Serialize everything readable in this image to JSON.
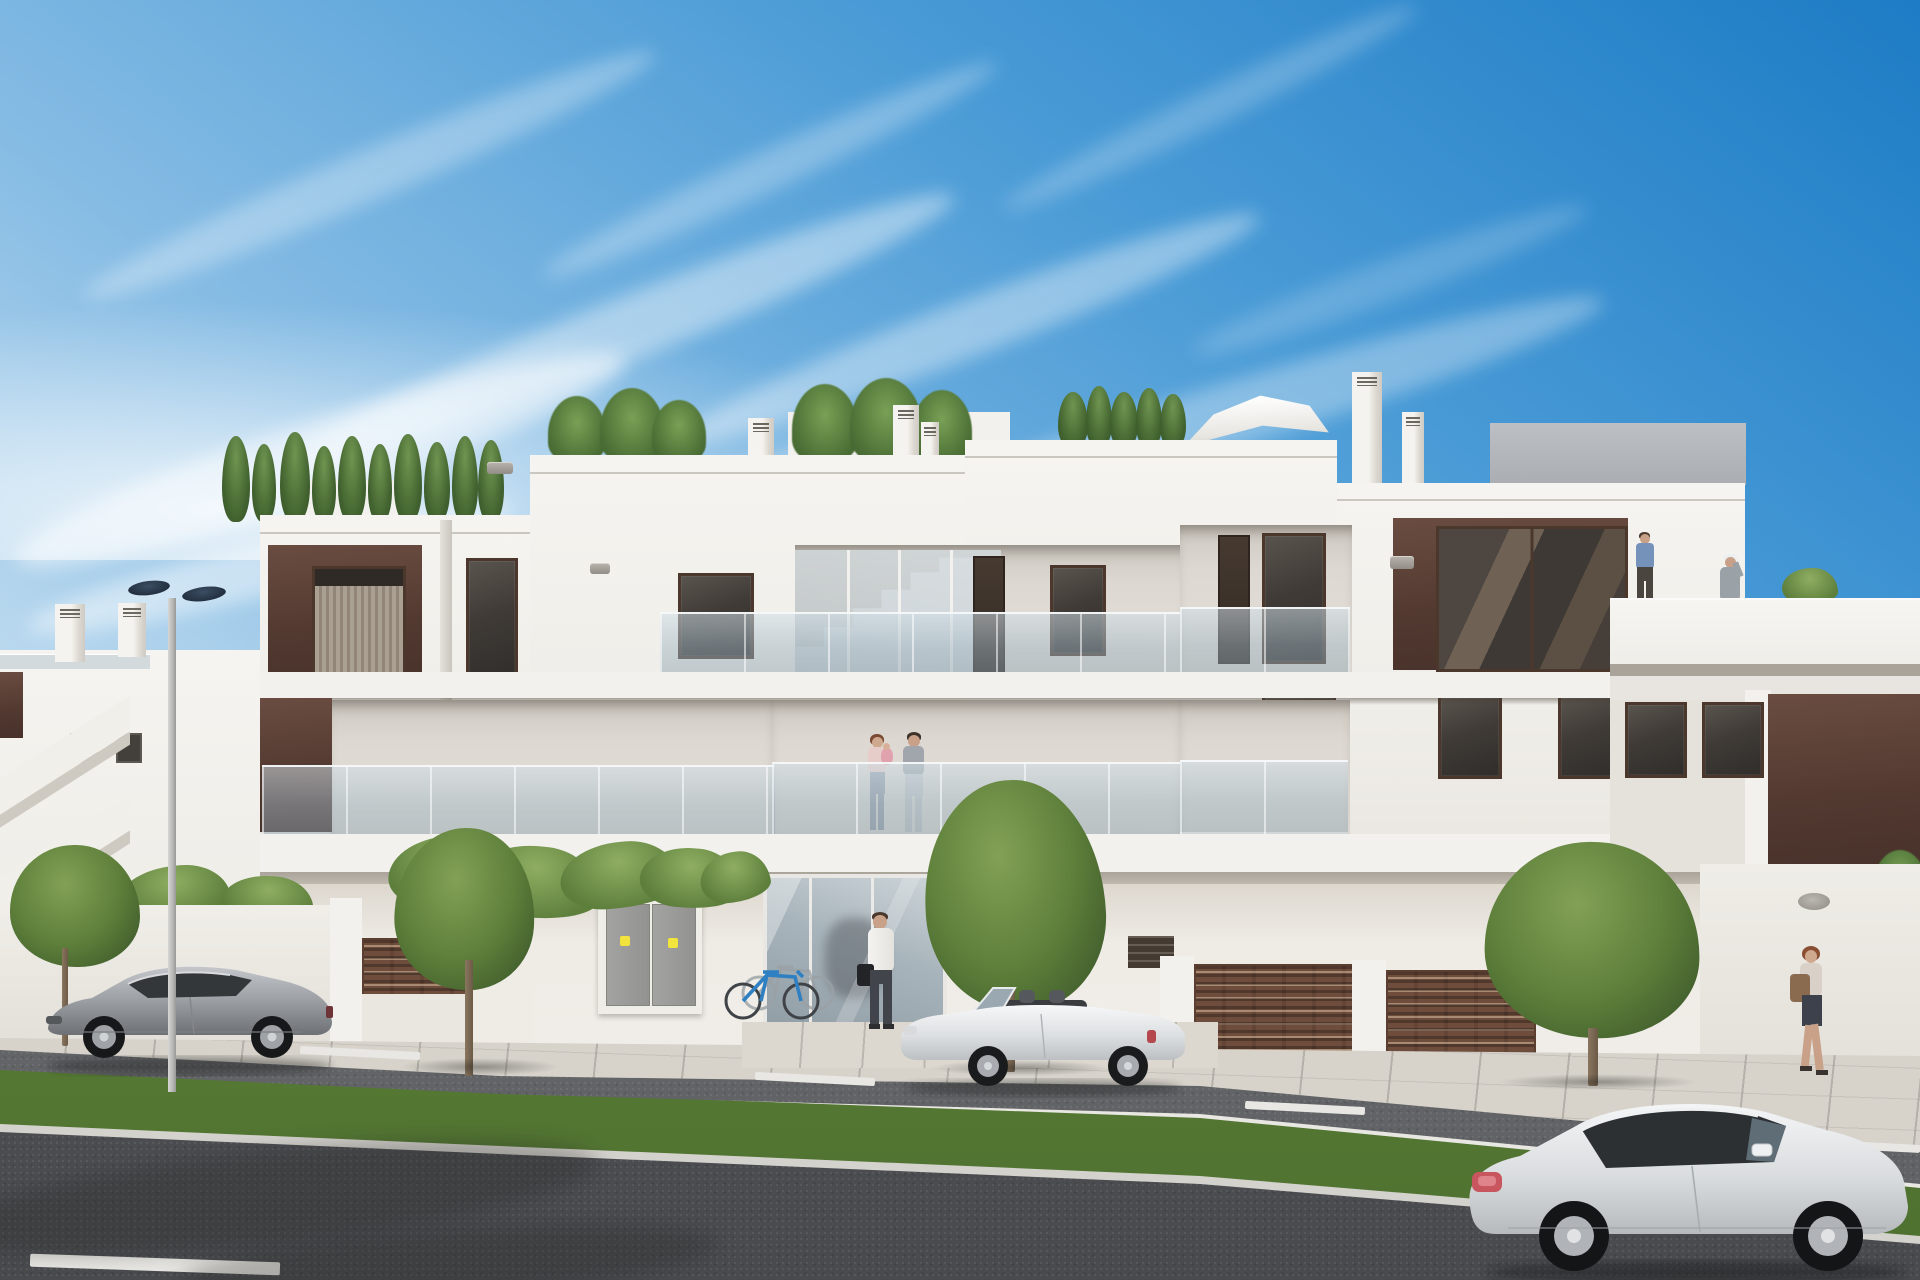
{
  "meta": {
    "title": "New-build apartment complex — exterior architectural rendering",
    "type": "photorealistic CGI render, street elevation, sunny day",
    "text_visible": "none"
  },
  "palette": {
    "sky_top": "#1d7cc5",
    "sky_mid": "#7ab5e2",
    "sky_horizon": "#e2eff8",
    "facade_white": "#f3f1ed",
    "facade_recess": "#ddd8d1",
    "accent_brown": "#5d433a",
    "window_frame": "#4b372c",
    "window_glass": "#403b37",
    "glass_railing": "#a9c0cc",
    "fence_brown": "#6f4d3d",
    "grass": "#5f8538",
    "road_asphalt": "#54565a",
    "sidewalk": "#d7d3cb",
    "tree_green": "#5d7f3a",
    "car_silver": "#9b9ea3",
    "car_white": "#eef0f1",
    "warning_sticker": "#f2e43c"
  },
  "objects": {
    "buildings": [
      "three-storey white apartment block with brown accent panels and glass balcony railings",
      "background low building with external staircase (left)",
      "receding right wing with roof terrace"
    ],
    "rooftop": [
      "conifer and palm planting",
      "white parasol",
      "chimneys",
      "antenna"
    ],
    "people": [
      "couple with baby on first-floor balcony",
      "man in white shirt at entrance",
      "woman walking on right sidewalk",
      "man in blue shirt on roof terrace",
      "woman with white cap on roof terrace"
    ],
    "vehicles": [
      "silver coupe parked left",
      "white convertible parked centre",
      "white sports coupe driving bottom right"
    ],
    "street": [
      "tiled sidewalk",
      "parking lane with dashed markings",
      "grass median",
      "main road",
      "street lamp with twin heads",
      "ornamental trees",
      "brown slatted fences",
      "utility cabinet with warning stickers",
      "bicycle rack with two bikes"
    ]
  },
  "scene": {
    "sprites": [
      {
        "k": "cloud",
        "t": "sky",
        "x": 60,
        "y": 150,
        "w": 620,
        "h": 50,
        "r": -23,
        "o": 0.3
      },
      {
        "k": "cloud",
        "t": "sky",
        "x": 260,
        "y": 300,
        "w": 720,
        "h": 64,
        "r": -22,
        "o": 0.42
      },
      {
        "k": "cloud",
        "t": "sky",
        "x": 0,
        "y": 420,
        "w": 640,
        "h": 80,
        "r": -18,
        "o": 0.5
      },
      {
        "k": "cloud",
        "t": "sky",
        "x": 520,
        "y": 150,
        "w": 500,
        "h": 40,
        "r": -25,
        "o": 0.28
      },
      {
        "k": "cloud",
        "t": "sky",
        "x": 660,
        "y": 300,
        "w": 620,
        "h": 56,
        "r": -21,
        "o": 0.38
      },
      {
        "k": "cloud",
        "t": "sky",
        "x": 980,
        "y": 90,
        "w": 460,
        "h": 36,
        "r": -26,
        "o": 0.22
      },
      {
        "k": "cloud",
        "t": "sky",
        "x": 860,
        "y": 380,
        "w": 760,
        "h": 64,
        "r": -17,
        "o": 0.32
      },
      {
        "k": "cloud",
        "t": "sky",
        "x": 20,
        "y": 540,
        "w": 500,
        "h": 54,
        "r": -14,
        "o": 0.45
      },
      {
        "k": "cloud",
        "t": "sky",
        "x": 1180,
        "y": 260,
        "w": 420,
        "h": 40,
        "r": -20,
        "o": 0.18
      },
      {
        "k": "cloud",
        "t": "sky",
        "x": 420,
        "y": 480,
        "w": 560,
        "h": 56,
        "r": -16,
        "o": 0.4
      },
      {
        "k": "conifer",
        "t": "flora",
        "x": 222,
        "y": 436,
        "w": 28,
        "h": 86
      },
      {
        "k": "conifer",
        "t": "flora",
        "x": 252,
        "y": 444,
        "w": 24,
        "h": 78
      },
      {
        "k": "conifer",
        "t": "flora",
        "x": 280,
        "y": 432,
        "w": 30,
        "h": 90
      },
      {
        "k": "conifer",
        "t": "flora",
        "x": 312,
        "y": 446,
        "w": 24,
        "h": 76
      },
      {
        "k": "conifer",
        "t": "flora",
        "x": 338,
        "y": 436,
        "w": 28,
        "h": 86
      },
      {
        "k": "conifer",
        "t": "flora",
        "x": 368,
        "y": 444,
        "w": 24,
        "h": 78
      },
      {
        "k": "conifer",
        "t": "flora",
        "x": 394,
        "y": 434,
        "w": 28,
        "h": 88
      },
      {
        "k": "conifer",
        "t": "flora",
        "x": 424,
        "y": 442,
        "w": 26,
        "h": 80
      },
      {
        "k": "conifer",
        "t": "flora",
        "x": 452,
        "y": 436,
        "w": 26,
        "h": 86
      },
      {
        "k": "conifer",
        "t": "flora",
        "x": 478,
        "y": 440,
        "w": 26,
        "h": 82
      },
      {
        "k": "palm",
        "t": "flora",
        "x": 548,
        "y": 396,
        "w": 58,
        "h": 66
      },
      {
        "k": "palm",
        "t": "flora",
        "x": 600,
        "y": 388,
        "w": 64,
        "h": 74
      },
      {
        "k": "palm",
        "t": "flora",
        "x": 652,
        "y": 400,
        "w": 54,
        "h": 62
      },
      {
        "k": "palm",
        "t": "flora",
        "x": 792,
        "y": 384,
        "w": 66,
        "h": 78
      },
      {
        "k": "palm",
        "t": "flora",
        "x": 850,
        "y": 378,
        "w": 72,
        "h": 84
      },
      {
        "k": "palm",
        "t": "flora",
        "x": 912,
        "y": 390,
        "w": 60,
        "h": 72
      },
      {
        "k": "conifer",
        "t": "flora",
        "x": 1058,
        "y": 392,
        "w": 30,
        "h": 56
      },
      {
        "k": "conifer",
        "t": "flora",
        "x": 1086,
        "y": 386,
        "w": 26,
        "h": 62
      },
      {
        "k": "conifer",
        "t": "flora",
        "x": 1110,
        "y": 392,
        "w": 28,
        "h": 56
      },
      {
        "k": "conifer",
        "t": "flora",
        "x": 1136,
        "y": 388,
        "w": 26,
        "h": 60
      },
      {
        "k": "conifer",
        "t": "flora",
        "x": 1160,
        "y": 394,
        "w": 26,
        "h": 54
      },
      {
        "k": "chimney",
        "t": "flora",
        "x": 55,
        "y": 604,
        "w": 30,
        "h": 58
      },
      {
        "k": "chimney",
        "t": "flora",
        "x": 118,
        "y": 603,
        "w": 28,
        "h": 54
      },
      {
        "k": "chimney",
        "t": "flora",
        "x": 748,
        "y": 418,
        "w": 26,
        "h": 40
      },
      {
        "k": "chimney",
        "t": "flora",
        "x": 893,
        "y": 405,
        "w": 26,
        "h": 52
      },
      {
        "k": "chimney",
        "t": "flora",
        "x": 921,
        "y": 422,
        "w": 18,
        "h": 34
      },
      {
        "k": "chimney",
        "t": "flora",
        "x": 1352,
        "y": 372,
        "w": 30,
        "h": 112
      },
      {
        "k": "chimney",
        "t": "flora",
        "x": 1402,
        "y": 412,
        "w": 22,
        "h": 72
      },
      {
        "k": "wblind",
        "t": "win",
        "x": 312,
        "y": 566,
        "w": 88,
        "h": 106
      },
      {
        "k": "wdark",
        "t": "win",
        "x": 466,
        "y": 558,
        "w": 46,
        "h": 120
      },
      {
        "k": "wdark",
        "t": "win",
        "x": 678,
        "y": 573,
        "w": 70,
        "h": 80
      },
      {
        "k": "door",
        "t": "win",
        "x": 973,
        "y": 556,
        "w": 28,
        "h": 118
      },
      {
        "k": "wdark",
        "t": "win",
        "x": 1050,
        "y": 565,
        "w": 50,
        "h": 85
      },
      {
        "k": "door",
        "t": "win",
        "x": 1218,
        "y": 535,
        "w": 28,
        "h": 125
      },
      {
        "k": "wdark",
        "t": "win",
        "x": 1262,
        "y": 533,
        "w": 58,
        "h": 125
      },
      {
        "k": "wdark",
        "t": "win",
        "x": 390,
        "y": 715,
        "w": 66,
        "h": 80
      },
      {
        "k": "wdark",
        "t": "win",
        "x": 560,
        "y": 715,
        "w": 60,
        "h": 80
      },
      {
        "k": "door",
        "t": "win",
        "x": 978,
        "y": 745,
        "w": 22,
        "h": 86
      },
      {
        "k": "door",
        "t": "win",
        "x": 1208,
        "y": 700,
        "w": 30,
        "h": 110
      },
      {
        "k": "wdark",
        "t": "win",
        "x": 1262,
        "y": 695,
        "w": 68,
        "h": 78
      },
      {
        "k": "wdark",
        "t": "win",
        "x": 1438,
        "y": 695,
        "w": 58,
        "h": 78
      },
      {
        "k": "wdark",
        "t": "win",
        "x": 1558,
        "y": 695,
        "w": 58,
        "h": 78
      },
      {
        "k": "wdark",
        "t": "win",
        "x": 530,
        "y": 858,
        "w": 62,
        "h": 82
      },
      {
        "k": "wdark",
        "t": "win",
        "x": 680,
        "y": 862,
        "w": 44,
        "h": 76
      },
      {
        "k": "wdark",
        "t": "win",
        "x": 1130,
        "y": 865,
        "w": 37,
        "h": 70
      },
      {
        "k": "wwide",
        "t": "win",
        "x": 1262,
        "y": 878,
        "w": 136,
        "h": 86
      },
      {
        "k": "wwide",
        "t": "win",
        "x": 1452,
        "y": 880,
        "w": 92,
        "h": 86
      },
      {
        "k": "grille",
        "t": "win",
        "x": 487,
        "y": 462,
        "w": 26,
        "h": 12
      },
      {
        "k": "grille",
        "t": "win",
        "x": 590,
        "y": 563,
        "w": 20,
        "h": 11
      },
      {
        "k": "grille",
        "t": "win",
        "x": 1390,
        "y": 556,
        "w": 24,
        "h": 13
      },
      {
        "k": "grille",
        "t": "win",
        "x": 1422,
        "y": 970,
        "w": 18,
        "h": 10
      },
      {
        "k": "grille",
        "t": "win",
        "x": 952,
        "y": 888,
        "w": 20,
        "h": 10
      },
      {
        "k": "wdark",
        "t": "winR",
        "x": 1625,
        "y": 702,
        "w": 56,
        "h": 70
      },
      {
        "k": "wdark",
        "t": "winR",
        "x": 1702,
        "y": 702,
        "w": 56,
        "h": 70
      },
      {
        "k": "bgwin",
        "t": "bg",
        "x": 70,
        "y": 733,
        "w": 24,
        "h": 26
      },
      {
        "k": "bgwin",
        "t": "bg",
        "x": 116,
        "y": 733,
        "w": 22,
        "h": 26
      },
      {
        "k": "leaf",
        "t": "plants",
        "x": 118,
        "y": 866,
        "w": 112,
        "h": 54,
        "r": -6
      },
      {
        "k": "leaf",
        "t": "plants",
        "x": 222,
        "y": 876,
        "w": 92,
        "h": 48,
        "r": 4
      },
      {
        "k": "leaf",
        "t": "plants",
        "x": 388,
        "y": 836,
        "w": 120,
        "h": 70,
        "r": -4
      },
      {
        "k": "leaf",
        "t": "plants",
        "x": 470,
        "y": 846,
        "w": 130,
        "h": 72,
        "r": 6
      },
      {
        "k": "leaf",
        "t": "plants",
        "x": 560,
        "y": 842,
        "w": 120,
        "h": 66,
        "r": -5
      },
      {
        "k": "leaf",
        "t": "plants",
        "x": 640,
        "y": 848,
        "w": 100,
        "h": 60,
        "r": 5
      },
      {
        "k": "leaf",
        "t": "plants",
        "x": 700,
        "y": 852,
        "w": 70,
        "h": 50,
        "r": -8
      },
      {
        "k": "dash",
        "t": "ground",
        "x": 300,
        "y": 1049,
        "w": 120,
        "h": 8,
        "r": 3
      },
      {
        "k": "dash",
        "t": "ground",
        "x": 755,
        "y": 1075,
        "w": 120,
        "h": 8,
        "r": 3
      },
      {
        "k": "dash",
        "t": "ground",
        "x": 1245,
        "y": 1104,
        "w": 120,
        "h": 8,
        "r": 3
      },
      {
        "k": "dash",
        "t": "ground",
        "x": 1595,
        "y": 1127,
        "w": 120,
        "h": 8,
        "r": 3
      },
      {
        "k": "dash",
        "t": "ground",
        "x": 1845,
        "y": 1143,
        "w": 75,
        "h": 8,
        "r": 3
      },
      {
        "k": "dash",
        "t": "ground",
        "x": 30,
        "y": 1258,
        "w": 250,
        "h": 13,
        "r": 2
      }
    ]
  }
}
